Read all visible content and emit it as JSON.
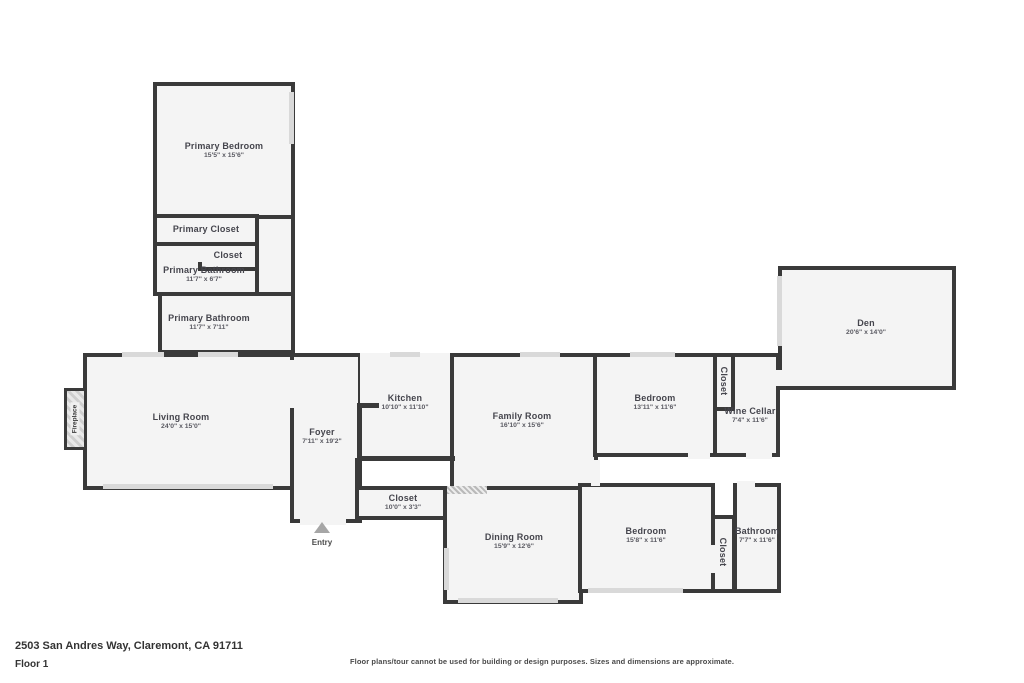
{
  "floorplan": {
    "colors": {
      "wall": "#3a3a3a",
      "room_fill": "#f4f4f4",
      "window": "#d9d9d9",
      "label_text": "#45454d"
    },
    "rooms": [
      {
        "id": "hallway",
        "label": "",
        "dims": "",
        "x": 255,
        "y": 214,
        "w": 40,
        "h": 145,
        "lx": 0,
        "ly": 0
      },
      {
        "id": "primary-bedroom",
        "label": "Primary Bedroom",
        "dims": "15'5\" x 15'6\"",
        "x": 153,
        "y": 82,
        "w": 142,
        "h": 137,
        "lx": 224,
        "ly": 150
      },
      {
        "id": "primary-closet",
        "label": "Primary Closet",
        "dims": "",
        "x": 153,
        "y": 214,
        "w": 106,
        "h": 33,
        "lx": 206,
        "ly": 229
      },
      {
        "id": "primary-bathroom-upper",
        "label": "Primary Bathroom",
        "dims": "11'7\" x 6'7\"",
        "x": 153,
        "y": 242,
        "w": 106,
        "h": 54,
        "lx": 204,
        "ly": 274
      },
      {
        "id": "closet-primary-small",
        "label": "Closet",
        "dims": "",
        "x": 198,
        "y": 242,
        "w": 61,
        "h": 29,
        "lx": 228,
        "ly": 255
      },
      {
        "id": "primary-bathroom-lower",
        "label": "Primary Bathroom",
        "dims": "11'7\" x 7'11\"",
        "x": 158,
        "y": 292,
        "w": 137,
        "h": 62,
        "lx": 209,
        "ly": 322
      },
      {
        "id": "living-room",
        "label": "Living Room",
        "dims": "24'0\" x 15'0\"",
        "x": 83,
        "y": 353,
        "w": 212,
        "h": 137,
        "lx": 181,
        "ly": 421
      },
      {
        "id": "foyer",
        "label": "Foyer",
        "dims": "7'11\" x 19'2\"",
        "x": 290,
        "y": 353,
        "w": 72,
        "h": 170,
        "lx": 322,
        "ly": 436
      },
      {
        "id": "kitchen",
        "label": "Kitchen",
        "dims": "10'10\" x 11'10\"",
        "x": 360,
        "y": 353,
        "w": 95,
        "h": 107,
        "lx": 405,
        "ly": 402,
        "noborder": true
      },
      {
        "id": "family-room",
        "label": "Family Room",
        "dims": "16'10\" x 15'6\"",
        "x": 450,
        "y": 353,
        "w": 148,
        "h": 139,
        "lx": 522,
        "ly": 420
      },
      {
        "id": "bedroom-upper",
        "label": "Bedroom",
        "dims": "13'11\" x 11'6\"",
        "x": 593,
        "y": 353,
        "w": 125,
        "h": 104,
        "lx": 655,
        "ly": 402
      },
      {
        "id": "wine-cellar",
        "label": "Wine Cellar",
        "dims": "7'4\" x 11'6\"",
        "x": 713,
        "y": 353,
        "w": 67,
        "h": 104,
        "lx": 750,
        "ly": 415
      },
      {
        "id": "closet-upper",
        "label": "Closet",
        "dims": "",
        "x": 713,
        "y": 353,
        "w": 22,
        "h": 58,
        "lx": 724,
        "ly": 381,
        "rotate": true
      },
      {
        "id": "den",
        "label": "Den",
        "dims": "20'6\" x 14'0\"",
        "x": 778,
        "y": 266,
        "w": 178,
        "h": 124,
        "lx": 866,
        "ly": 327
      },
      {
        "id": "closet-hall",
        "label": "Closet",
        "dims": "10'0\" x 3'3\"",
        "x": 355,
        "y": 486,
        "w": 105,
        "h": 34,
        "lx": 403,
        "ly": 502
      },
      {
        "id": "dining-room",
        "label": "Dining Room",
        "dims": "15'9\" x 12'6\"",
        "x": 443,
        "y": 486,
        "w": 140,
        "h": 118,
        "lx": 514,
        "ly": 541
      },
      {
        "id": "bedroom-lower",
        "label": "Bedroom",
        "dims": "15'8\" x 11'6\"",
        "x": 578,
        "y": 483,
        "w": 137,
        "h": 110,
        "lx": 646,
        "ly": 535
      },
      {
        "id": "bathroom",
        "label": "Bathroom",
        "dims": "7'7\" x 11'6\"",
        "x": 733,
        "y": 483,
        "w": 48,
        "h": 110,
        "lx": 757,
        "ly": 535
      },
      {
        "id": "closet-lower",
        "label": "Closet",
        "dims": "",
        "x": 711,
        "y": 515,
        "w": 25,
        "h": 78,
        "lx": 723,
        "ly": 552,
        "rotate": true
      }
    ],
    "walls": [
      {
        "id": "kitchen-counter-vertical",
        "x": 357,
        "y": 403,
        "w": 5,
        "h": 58
      },
      {
        "id": "kitchen-counter-stub",
        "x": 357,
        "y": 403,
        "w": 22,
        "h": 5
      },
      {
        "id": "kitchen-counter-bottom",
        "x": 360,
        "y": 456,
        "w": 95,
        "h": 5
      },
      {
        "id": "foyer-closet-link",
        "x": 355,
        "y": 458,
        "w": 5,
        "h": 32
      }
    ],
    "windows": [
      {
        "id": "living-bottom-window",
        "x": 103,
        "y": 484,
        "w": 170,
        "h": 5
      },
      {
        "id": "living-top-window-a",
        "x": 122,
        "y": 352,
        "w": 42,
        "h": 5
      },
      {
        "id": "living-top-window-b",
        "x": 198,
        "y": 352,
        "w": 40,
        "h": 5
      },
      {
        "id": "primary-bedroom-right-window",
        "x": 289,
        "y": 92,
        "w": 5,
        "h": 52
      },
      {
        "id": "den-left-window",
        "x": 777,
        "y": 276,
        "w": 5,
        "h": 70
      },
      {
        "id": "dining-left-window",
        "x": 444,
        "y": 548,
        "w": 5,
        "h": 42
      },
      {
        "id": "dining-bottom-window",
        "x": 458,
        "y": 598,
        "w": 100,
        "h": 5
      },
      {
        "id": "bedroom-lower-bottom-window",
        "x": 588,
        "y": 588,
        "w": 95,
        "h": 5
      },
      {
        "id": "family-top-window",
        "x": 520,
        "y": 352,
        "w": 40,
        "h": 5
      },
      {
        "id": "kitchen-top-window",
        "x": 390,
        "y": 352,
        "w": 30,
        "h": 5
      },
      {
        "id": "bedroom-upper-top-window",
        "x": 630,
        "y": 352,
        "w": 45,
        "h": 5
      }
    ],
    "sliders": [
      {
        "id": "dining-slider-door",
        "x": 447,
        "y": 486,
        "w": 40,
        "h": 8
      }
    ],
    "doors": [
      {
        "id": "entry-door-opening",
        "x": 300,
        "y": 516,
        "w": 46,
        "h": 9
      },
      {
        "id": "living-foyer-opening",
        "x": 288,
        "y": 360,
        "w": 9,
        "h": 48
      },
      {
        "id": "family-hall-opening",
        "x": 591,
        "y": 460,
        "w": 9,
        "h": 26
      },
      {
        "id": "bedroom-upper-door",
        "x": 688,
        "y": 452,
        "w": 22,
        "h": 7
      },
      {
        "id": "wine-cellar-door",
        "x": 746,
        "y": 452,
        "w": 26,
        "h": 7
      },
      {
        "id": "den-door",
        "x": 775,
        "y": 370,
        "w": 9,
        "h": 16
      },
      {
        "id": "bathroom-door",
        "x": 737,
        "y": 481,
        "w": 18,
        "h": 8
      },
      {
        "id": "primary-closet-door",
        "x": 196,
        "y": 246,
        "w": 7,
        "h": 16
      },
      {
        "id": "closet-lower-door",
        "x": 709,
        "y": 545,
        "w": 8,
        "h": 28
      }
    ],
    "fireplace": {
      "label": "Fireplace",
      "x": 64,
      "y": 388,
      "w": 23,
      "h": 62,
      "lx": 75,
      "ly": 419
    },
    "entry": {
      "label": "Entry",
      "arrow_x": 322,
      "arrow_y": 522,
      "label_x": 322,
      "label_y": 538
    }
  },
  "footer": {
    "address": "2503 San Andres Way, Claremont, CA 91711",
    "floor": "Floor 1",
    "disclaimer": "Floor plans/tour cannot be used for building or design purposes. Sizes and dimensions are approximate."
  }
}
